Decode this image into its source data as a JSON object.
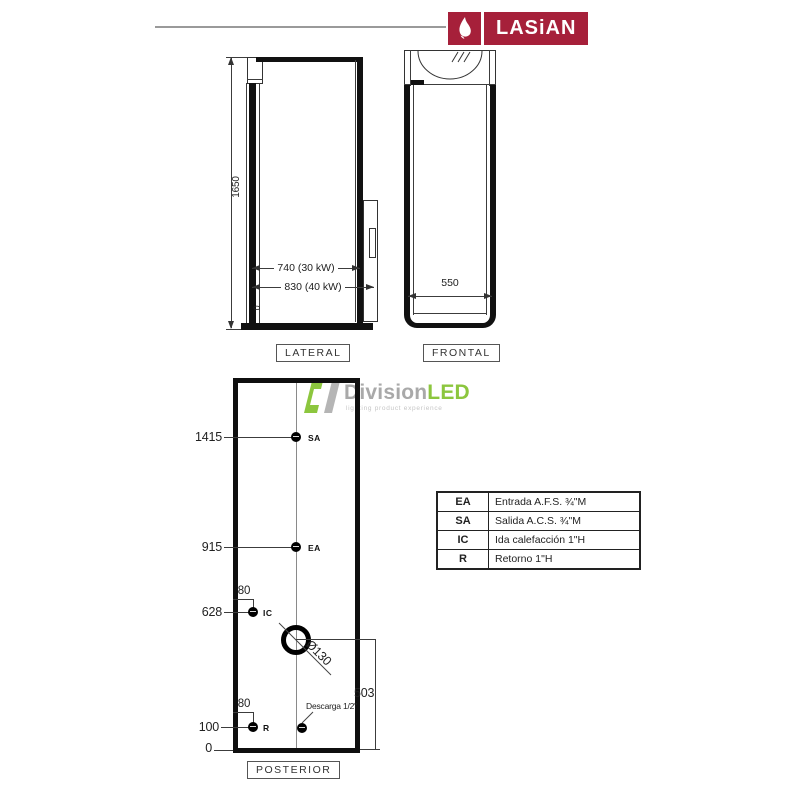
{
  "brand": {
    "name": "LASiAN",
    "red": "#a6203a"
  },
  "watermark": {
    "word_main": "Division",
    "word_accent": "LED",
    "tagline": "lighting product experience",
    "green": "#8cc63e",
    "gray": "#a9a9a9"
  },
  "views": {
    "lateral": {
      "label": "LATERAL",
      "dim_height": "1650",
      "dim_width_30kw": "740 (30 kW)",
      "dim_width_40kw": "830 (40 kW)",
      "dim_zero": "0"
    },
    "frontal": {
      "label": "FRONTAL",
      "dim_width": "550"
    },
    "posterior": {
      "label": "POSTERIOR",
      "dim_sa": "1415",
      "dim_ea": "915",
      "dim_ic": "628",
      "dim_ic_offset": "80",
      "dim_r": "100",
      "dim_r_offset": "80",
      "dim_zero": "0",
      "dim_flue": "Ø130",
      "dim_flue_bottom": "503",
      "drain_label": "Descarga 1/2\"",
      "conn_sa": "SA",
      "conn_ea": "EA",
      "conn_ic": "IC",
      "conn_r": "R"
    }
  },
  "legend": {
    "rows": [
      {
        "code": "EA",
        "desc": "Entrada A.F.S. ¾\"M"
      },
      {
        "code": "SA",
        "desc": "Salida A.C.S. ¾\"M"
      },
      {
        "code": "IC",
        "desc": "Ida calefacción 1\"H"
      },
      {
        "code": "R",
        "desc": "Retorno 1\"H"
      }
    ]
  }
}
